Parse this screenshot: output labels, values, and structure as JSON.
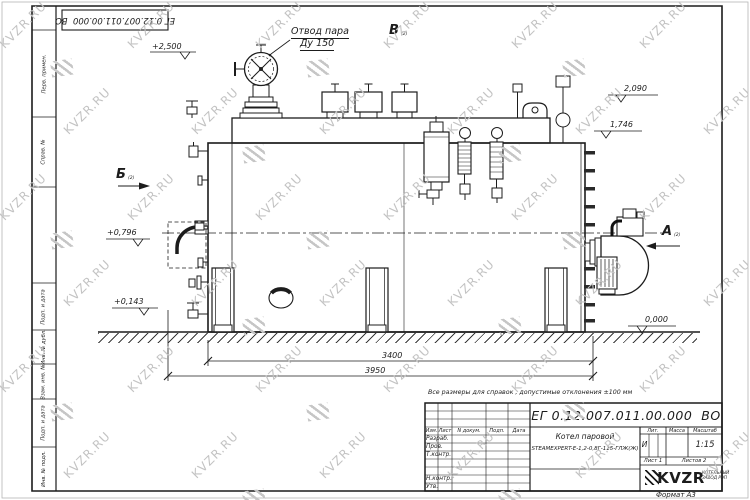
{
  "sheet": {
    "stamp_top_left": "ЕГ 0.12.007.011.00.000  ВО",
    "note": "Все размеры для справок , допустимые отклонения  ±100  мм",
    "format_label": "Формат А3",
    "side_labels": [
      "Перв. примен.",
      "Справ. №",
      "Подп. и дата",
      "Инв. № дубл.",
      "Взам. инв. №",
      "Подп. и дата",
      "Инв. № подл."
    ]
  },
  "watermark": {
    "text": "KVZR.RU"
  },
  "drawing": {
    "callout": {
      "line1": "Отвод пара",
      "line2": "Ду 150"
    },
    "views": {
      "b": "Б",
      "v": "В",
      "a": "А",
      "ref": "(2)"
    },
    "elevations": {
      "e2500": "+2,500",
      "e2090": "2,090",
      "e1746": "1,746",
      "e0796": "+0,796",
      "e0143": "+0,143",
      "e0000": "0,000"
    },
    "dimensions": {
      "d3400": "3400",
      "d3950": "3950"
    }
  },
  "title_block": {
    "doc_number": "ЕГ 0.12.007.011.00.000  ВО",
    "header_cols": [
      "Изм.",
      "Лист",
      "N докум.",
      "Подп.",
      "Дата"
    ],
    "rows": [
      "Разраб.",
      "Пров.",
      "Т.контр.",
      "Н.контр.",
      "Утв."
    ],
    "product_name_line1": "Котел паровой",
    "product_name_line2": "STEAMEXPERT-Е-1,2-0,8Г-115-ГЛЖ(Ж)",
    "lit_label": "Лит.",
    "lit_value": "И",
    "mass_label": "Масса",
    "scale_label": "Масштаб",
    "scale_value": "1:15",
    "sheet_label": "Лист 1",
    "sheets_label": "Листов 2",
    "company": {
      "logo_text": "KVZR",
      "tagline_line1": "КОТЕЛЬНЫЙ",
      "tagline_line2": "ЗАВОД РЭП"
    }
  }
}
